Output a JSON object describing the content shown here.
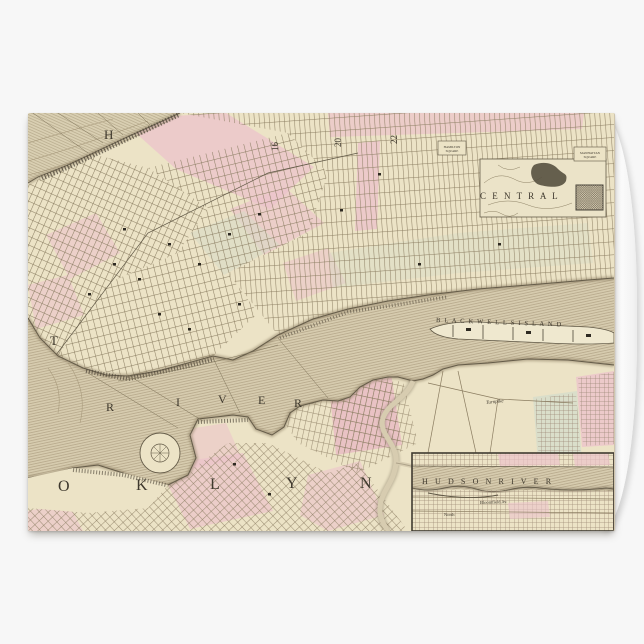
{
  "page": {
    "background": "#f7f7f7"
  },
  "card": {
    "kind": "folded greeting card mockup",
    "face": "antique map of New York City and Brooklyn, full bleed"
  },
  "map": {
    "description": "Vintage hand-colored street map: Manhattan with Central Park, East River with Blackwells Island, Brooklyn, and a Hudson River inset",
    "colors": {
      "parchment": "#ece3c6",
      "water": "#d6cbae",
      "ward_pink": "#ecc3cb",
      "ward_sage": "#d8dbc6",
      "ink": "#3e382d",
      "street_line": "#8a7c60",
      "shoreline": "#655c49",
      "reservoir_dark": "#57503f",
      "card_white": "#ffffff",
      "fold_shade": "#d4d4d4",
      "page_background": "#f7f7f7"
    },
    "visible_place_text": [
      "H",
      "T",
      "RIVER",
      "OKLYN",
      "CENTRAL",
      "BLACKWELLS ISLAND",
      "16",
      "20",
      "22",
      "HAMILTON SQUARE",
      "MANHATTAN SQUARE",
      "Turnpike",
      "HUDSON RIVER",
      "Bloomfield Av.",
      "North"
    ],
    "labels": [
      {
        "id": "label-hudson-h",
        "text": "H",
        "x": 76,
        "y": 26,
        "size": 13
      },
      {
        "id": "label-east-t",
        "text": "T",
        "x": 22,
        "y": 232,
        "size": 13
      },
      {
        "id": "label-east-river-r1",
        "text": "R",
        "x": 78,
        "y": 298,
        "size": 12
      },
      {
        "id": "label-east-river-i",
        "text": "I",
        "x": 148,
        "y": 293,
        "size": 12
      },
      {
        "id": "label-east-river-v",
        "text": "V",
        "x": 190,
        "y": 290,
        "size": 12
      },
      {
        "id": "label-east-river-e",
        "text": "E",
        "x": 230,
        "y": 291,
        "size": 12
      },
      {
        "id": "label-east-river-r2",
        "text": "R",
        "x": 266,
        "y": 294,
        "size": 12
      },
      {
        "id": "label-brooklyn-o",
        "text": "O",
        "x": 30,
        "y": 378,
        "size": 16
      },
      {
        "id": "label-brooklyn-k",
        "text": "K",
        "x": 108,
        "y": 377,
        "size": 16
      },
      {
        "id": "label-brooklyn-l",
        "text": "L",
        "x": 182,
        "y": 376,
        "size": 16
      },
      {
        "id": "label-brooklyn-y",
        "text": "Y",
        "x": 258,
        "y": 375,
        "size": 16
      },
      {
        "id": "label-brooklyn-n",
        "text": "N",
        "x": 332,
        "y": 375,
        "size": 16
      },
      {
        "id": "label-central-park",
        "text": "C E N T R A L",
        "x": 452,
        "y": 86,
        "size": 9,
        "ls": 2
      },
      {
        "id": "label-blackwells-island",
        "text": "B L A C K W E L L S   I S L A N D",
        "x": 408,
        "y": 209,
        "size": 6.5,
        "ls": 1.2,
        "rot": 2
      },
      {
        "id": "label-ward-16",
        "text": "16",
        "x": 250,
        "y": 38,
        "size": 9,
        "rot": -90
      },
      {
        "id": "label-ward-20",
        "text": "20",
        "x": 313,
        "y": 34,
        "size": 9,
        "rot": -90
      },
      {
        "id": "label-ward-22",
        "text": "22",
        "x": 369,
        "y": 31,
        "size": 9,
        "rot": -90
      },
      {
        "id": "label-square-1-line1",
        "text": "HAMILTON",
        "x": 424,
        "y": 35,
        "size": 3.2,
        "anchor": "middle"
      },
      {
        "id": "label-square-1-line2",
        "text": "SQUARE",
        "x": 424,
        "y": 39,
        "size": 3.2,
        "anchor": "middle"
      },
      {
        "id": "label-square-2-line1",
        "text": "MANHATTAN",
        "x": 562,
        "y": 41,
        "size": 3.2,
        "anchor": "middle"
      },
      {
        "id": "label-square-2-line2",
        "text": "SQUARE",
        "x": 562,
        "y": 45,
        "size": 3.2,
        "anchor": "middle"
      },
      {
        "id": "label-turnpike",
        "text": "Turnpike",
        "x": 458,
        "y": 291,
        "size": 5,
        "italic": true,
        "rot": -6
      },
      {
        "id": "label-inset-hudson-river",
        "text": "H U D S O N   R I V E R",
        "x": 394,
        "y": 371,
        "size": 8,
        "ls": 2.6,
        "layer": "inset"
      },
      {
        "id": "label-inset-bloomfield",
        "text": "Bloomfield Av.",
        "x": 452,
        "y": 391,
        "size": 4.5,
        "rot": -2,
        "layer": "inset"
      },
      {
        "id": "label-inset-north",
        "text": "North",
        "x": 416,
        "y": 403,
        "size": 4.5,
        "layer": "inset"
      }
    ]
  }
}
